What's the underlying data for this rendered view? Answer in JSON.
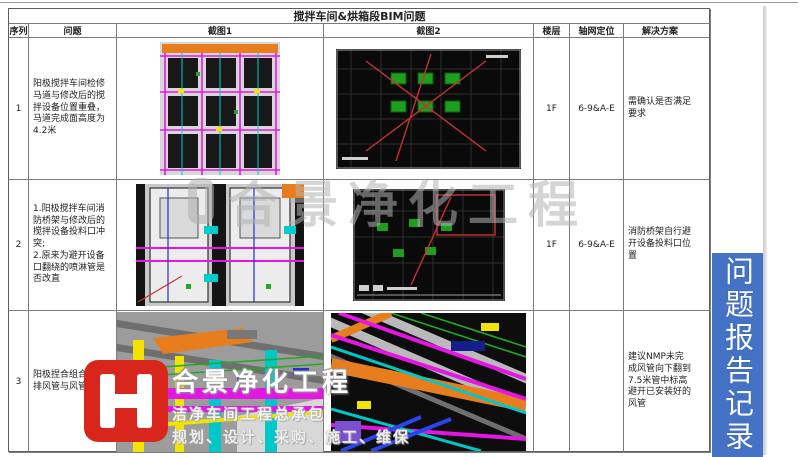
{
  "table": {
    "title": "搅拌车间&烘箱段BIM问题",
    "headers": {
      "seq": "序列",
      "problem": "问题",
      "shot1": "截图1",
      "shot2": "截图2",
      "floor": "楼层",
      "axis": "轴网定位",
      "solution": "解决方案"
    },
    "rows": [
      {
        "seq": "1",
        "problem": "阳极搅拌车间检修马道与修改后的搅拌设备位置重叠，马道完成面高度为4.2米",
        "floor": "1F",
        "axis": "6-9&A-E",
        "solution": "需确认是否满足要求"
      },
      {
        "seq": "2",
        "problem": "1.阳极搅拌车间消防桥架与修改后的搅拌设备投料口冲突;\n2.原来为避开设备口翻绕的喷淋管是否改直",
        "floor": "1F",
        "axis": "6-9&A-E",
        "solution": "消防桥架自行避开设备投料口位置"
      },
      {
        "seq": "3",
        "problem": "阳极捏合组合机尾排风管与风管干涉",
        "floor": "",
        "axis": "",
        "solution": "建议NMP未完成风管向下翻到7.5米管中标高　避开已安装好的风管"
      }
    ]
  },
  "watermark": {
    "text": "合景净化工程"
  },
  "brand": {
    "name": "合景净化工程",
    "tagline": "洁净车间工程总承包",
    "services": "规划、设计、采购、施工、维保"
  },
  "banner": {
    "text": "问题报告记录"
  }
}
